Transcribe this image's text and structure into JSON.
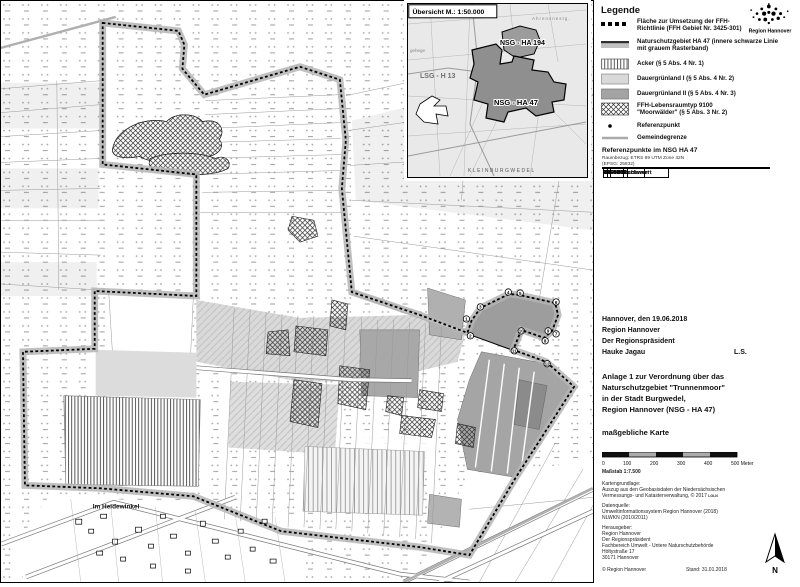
{
  "colors": {
    "grassland1": "#d9d9d9",
    "grassland2": "#a3a3a3",
    "nsg_band": "#b5b5b5",
    "inset_bg": "#e9e9e9"
  },
  "inset": {
    "title": "Übersicht M.: 1:50.000",
    "labels": {
      "lsg": "LSG - H 13",
      "nsg194": "NSG - HA 194",
      "nsg47": "NSG - HA 47",
      "town": "KLEINBURGWEDEL",
      "ahrens": "Ahrensnestg.",
      "gehege": "gehege"
    }
  },
  "map": {
    "settlement_label": "Im Heidewinkel",
    "ref_points": [
      "1",
      "2",
      "3",
      "4",
      "5",
      "6",
      "7",
      "8",
      "9",
      "10",
      "11",
      "12"
    ]
  },
  "legend": {
    "title": "Legende",
    "logo_label": "Region Hannover",
    "items": [
      {
        "l1": "Fläche zur Umsetzung der FFH-",
        "l2": "Richtlinie (FFH Gebiet Nr. 3425-301)"
      },
      {
        "l1": "Naturschutzgebiet HA 47 (innere schwarze Linie",
        "l2": "mit grauem Rasterband)"
      },
      {
        "l1": "Acker (§ 5 Abs. 4 Nr. 1)"
      },
      {
        "l1": "Dauergrünland I (§ 5 Abs. 4 Nr. 2)"
      },
      {
        "l1": "Dauergrünland II (§ 5 Abs. 4 Nr. 3)"
      },
      {
        "l1": "FFH-Lebensraumtyp 9100",
        "l2": "\"Moorwälder\" (§ 5 Abs. 3 Nr. 2)"
      },
      {
        "l1": "Referenzpunkt"
      },
      {
        "l1": "Gemeindegrenze"
      }
    ]
  },
  "ref_table": {
    "title": "Referenzpunkte im NSG HA 47",
    "sub1": "Raumbezug: ETRS 89 UTM Zone 32N",
    "sub2": "(EPSG: 25832)",
    "headers": [
      "Nr.",
      "Rechtswert",
      "Hochwert"
    ],
    "rows": [
      [
        "1",
        "560489",
        "5820538"
      ],
      [
        "2",
        "560490",
        "5820551"
      ],
      [
        "3",
        "560525",
        "5820657"
      ],
      [
        "4",
        "560627",
        "5820698"
      ],
      [
        "5",
        "560668",
        "5820699"
      ],
      [
        "6",
        "560800",
        "5820660"
      ],
      [
        "7",
        "560783",
        "5820557"
      ],
      [
        "8",
        "560775",
        "5820559"
      ],
      [
        "9",
        "560756",
        "5820536"
      ],
      [
        "10",
        "560671",
        "5820568"
      ],
      [
        "11",
        "560645",
        "5820491"
      ],
      [
        "12",
        "560766",
        "5820646"
      ]
    ]
  },
  "signature": {
    "line1": "Hannover, den 19.06.2018",
    "line2": "Region Hannover",
    "line3": "Der Regionspräsident",
    "line4": "Hauke Jagau",
    "ls": "L.S."
  },
  "title_block": {
    "line1": "Anlage 1 zur Verordnung über das",
    "line2": "Naturschutzgebiet \"Trunnenmoor\"",
    "line3": "in der Stadt Burgwedel,",
    "line4": "Region Hannover (NSG - HA 47)",
    "emphasis": "maßgebliche Karte"
  },
  "scale": {
    "t0": "0",
    "t1": "100",
    "t2": "200",
    "t3": "300",
    "t4": "400",
    "t5": "500 Meter",
    "ratio": "Maßstab 1:7.500"
  },
  "credits": {
    "base_title": "Kartengrundlage:",
    "base_l1": "Auszug aus den Geobasisdaten der Niedersächsischen",
    "base_l2": "Vermessungs- und Katasterverwaltung, © 2017",
    "base_logo": "LGLN",
    "source_title": "Datenquelle:",
    "source_l1": "Umweltinformationssystem Region Hannover (2018)",
    "source_l2": "NLWKN (2010/2011)",
    "pub_title": "Herausgeber:",
    "pub_l1": "Region Hannover",
    "pub_l2": "Der Regionspräsident",
    "pub_l3": "Fachbereich Umwelt - Untere Naturschutzbehörde",
    "pub_l4": "Höltystraße 17",
    "pub_l5": "30171 Hannover",
    "copyright": "© Region Hannover",
    "stand": "Stand: 31.01.2018"
  },
  "compass": {
    "label": "N"
  }
}
